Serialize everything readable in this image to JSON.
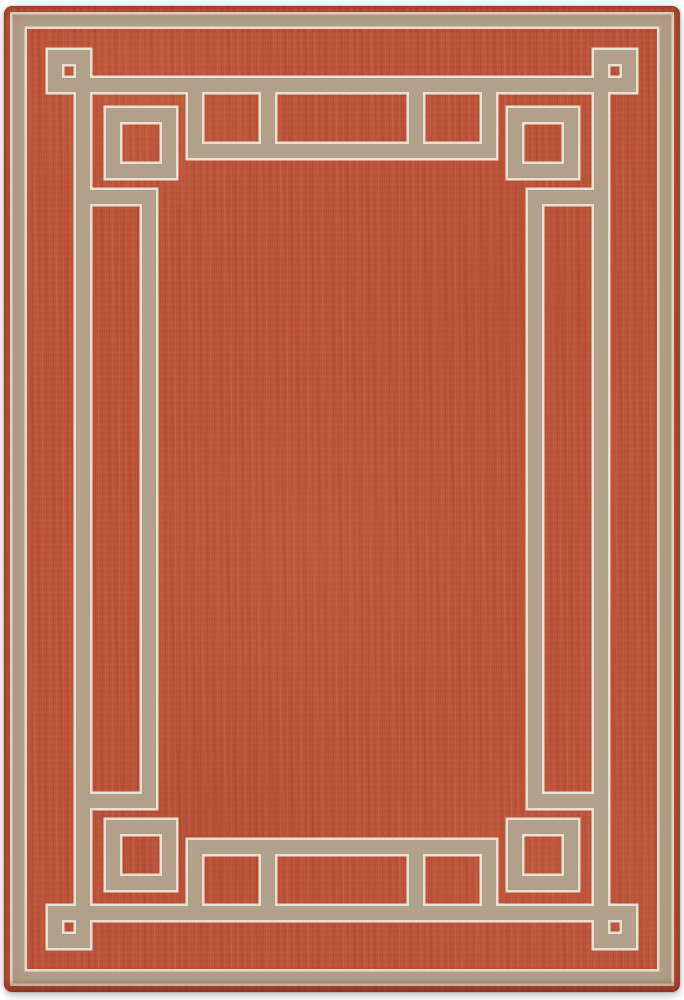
{
  "image": {
    "type": "product-photo",
    "subject": "rectangular flat-weave area rug with Greek-key fretwork border",
    "orientation": "portrait",
    "background": "#ffffff"
  },
  "canvas": {
    "width": 684,
    "height": 1000
  },
  "rug": {
    "margin": {
      "top": 6,
      "right": 4,
      "bottom": 8,
      "left": 4
    },
    "corner_radius": 8,
    "colors": {
      "field_red": "#bd5239",
      "field_red_dark": "#a84631",
      "field_red_light": "#d07a52",
      "band_tan": "#b1a08a",
      "edge_cream": "#e8e0d0",
      "binding_dark": "#8e3b28",
      "backdrop_white": "#ffffff"
    },
    "pattern": {
      "units": "rug-local px, area 676 x 986",
      "band_thickness": 14,
      "outer_band_thickness": 12,
      "cream_edge_extra": 5,
      "outer_ring_inset": 14.5,
      "second_ring_inset": 79,
      "main_ring_inset": 145,
      "hook_offset": 191,
      "small_square": {
        "centerline_near_inset": 51,
        "centerline_size": 28
      },
      "large_square": {
        "centerline_near_inset": 109,
        "centerline_size": 56
      },
      "center_rung_half_span": 74
    }
  }
}
